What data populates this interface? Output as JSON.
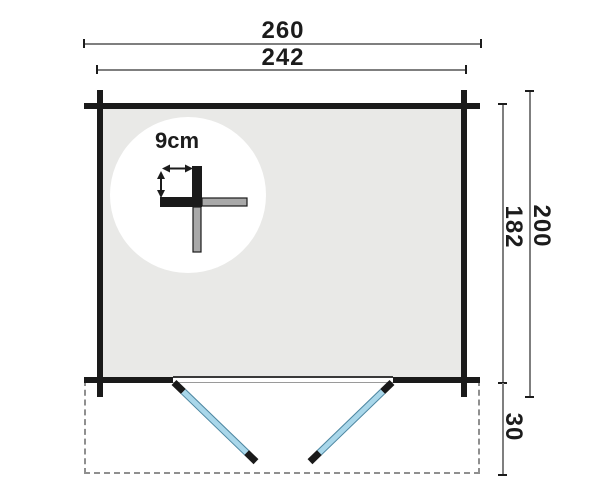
{
  "diagram": {
    "kind": "log-cabin floor plan with canopy and double door"
  },
  "labels": {
    "outer_width": "260",
    "inner_width": "242",
    "outer_depth": "200",
    "inner_depth": "182",
    "canopy_depth": "30",
    "door_size": "161x181",
    "wall_thickness": "9cm"
  },
  "colors": {
    "background": "#ffffff",
    "wall": "#1a1a1a",
    "interior": "#e9e9e7",
    "dimline": "#7f7f7f",
    "text": "#1c1c1c",
    "door_blue": "#a9d7ea",
    "door_blue_dark": "#4e86a0",
    "detail_gray": "#a9a9a9",
    "dashed_gray": "#8f8f8f"
  }
}
